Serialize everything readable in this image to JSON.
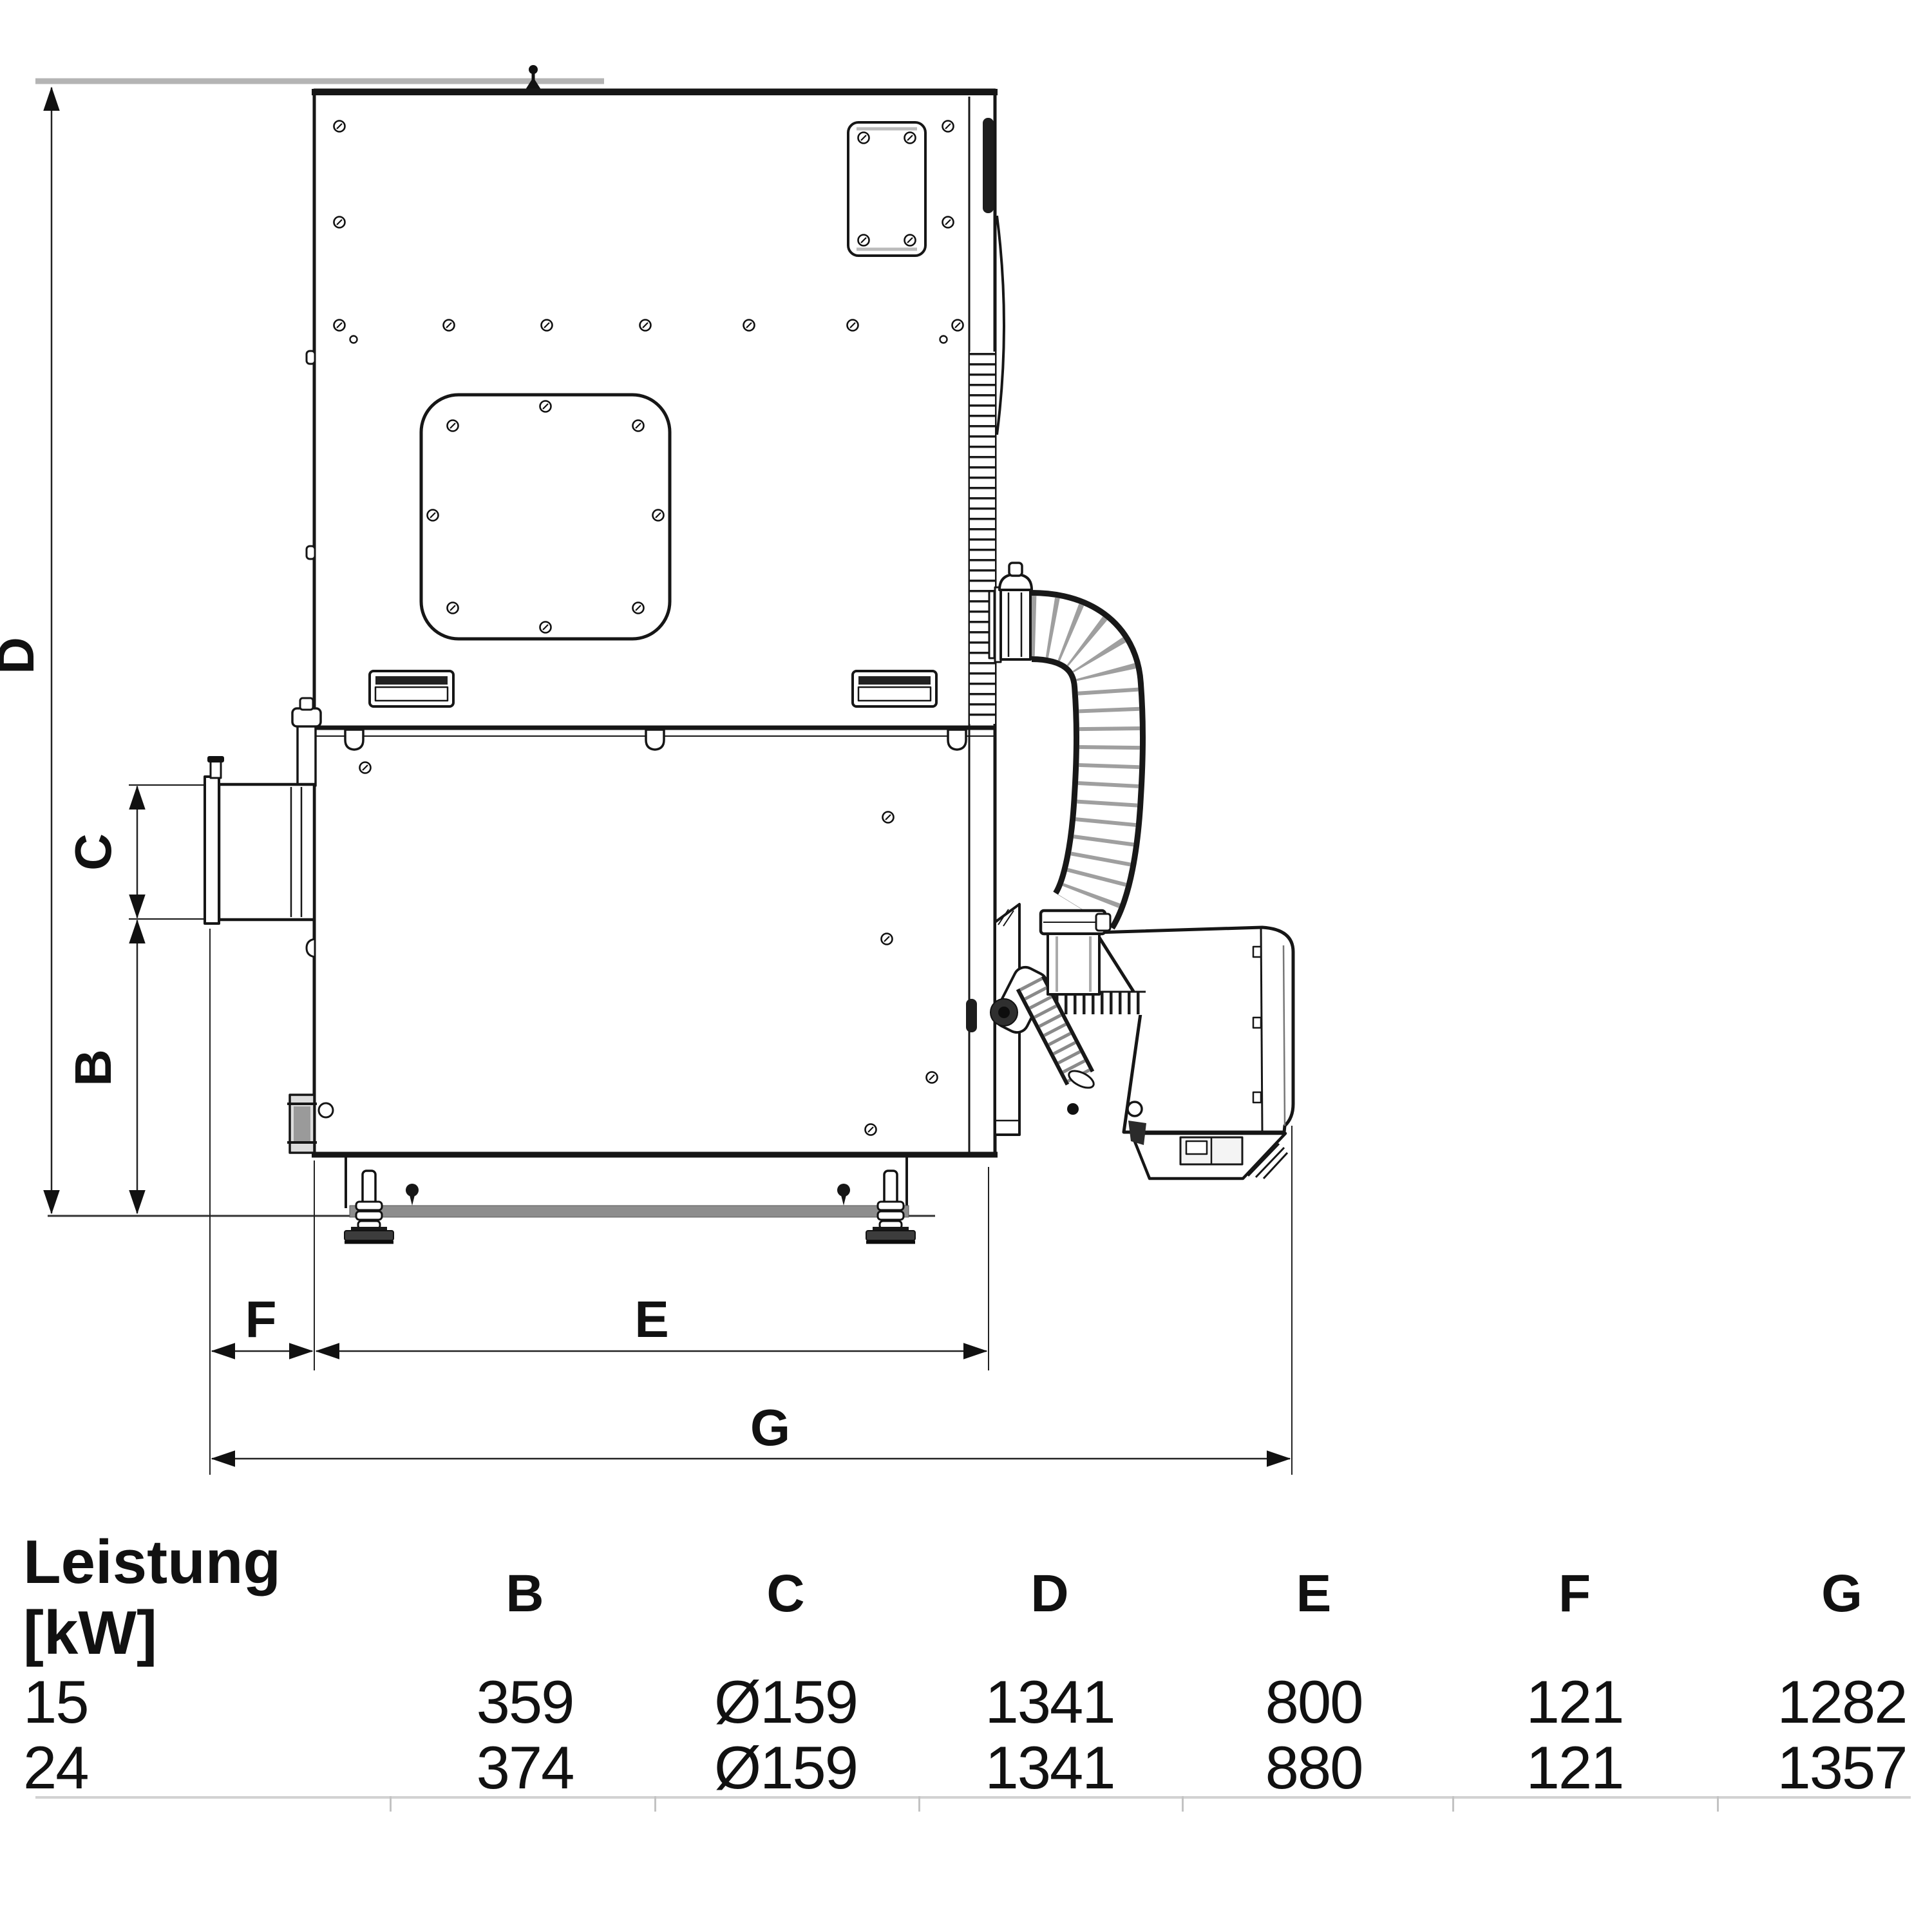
{
  "drawing": {
    "labels": {
      "D": "D",
      "C": "C",
      "B": "B",
      "F": "F",
      "E": "E",
      "G": "G"
    }
  },
  "table": {
    "header_line1": "Leistung",
    "header_line2": "[kW]",
    "columns": [
      "B",
      "C",
      "D",
      "E",
      "F",
      "G"
    ],
    "rows": [
      {
        "kw": "15",
        "B": "359",
        "C": "Ø159",
        "D": "1341",
        "E": "800",
        "F": "121",
        "G": "1282"
      },
      {
        "kw": "24",
        "B": "374",
        "C": "Ø159",
        "D": "1341",
        "E": "880",
        "F": "121",
        "G": "1357"
      }
    ]
  }
}
